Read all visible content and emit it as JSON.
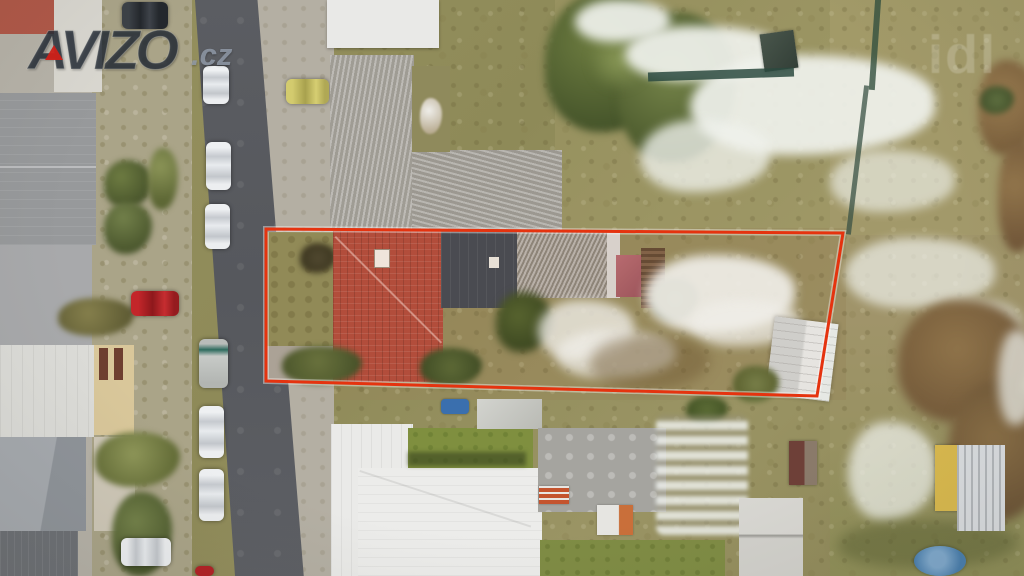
{
  "watermark": {
    "brand": "AVIZO",
    "tld": ".cz",
    "brand_color": "#282f3a",
    "accent_color": "#cc241c",
    "tld_color": "#949eac",
    "partial_text": "idl"
  },
  "overlay": {
    "outline_color": "#e5330f",
    "outline_glow": "rgba(255,255,255,0.4)",
    "outline_points": "266,229 843,233 817,396 266,381",
    "outline_width": "3"
  },
  "scene": {
    "palette": {
      "road": "#595c61",
      "pavement": "#b6b2a8",
      "grass_olive": "#94905e",
      "snow": "#eef0ec",
      "red_roof": "#b14e3c",
      "dark_roof": "#474c52",
      "weathered_roof": "#9c968a",
      "white_roof": "#ebebe9",
      "tree_green": "#55652f",
      "bare_brown": "#8a7148",
      "pool_blue": "#4a7fae"
    }
  }
}
